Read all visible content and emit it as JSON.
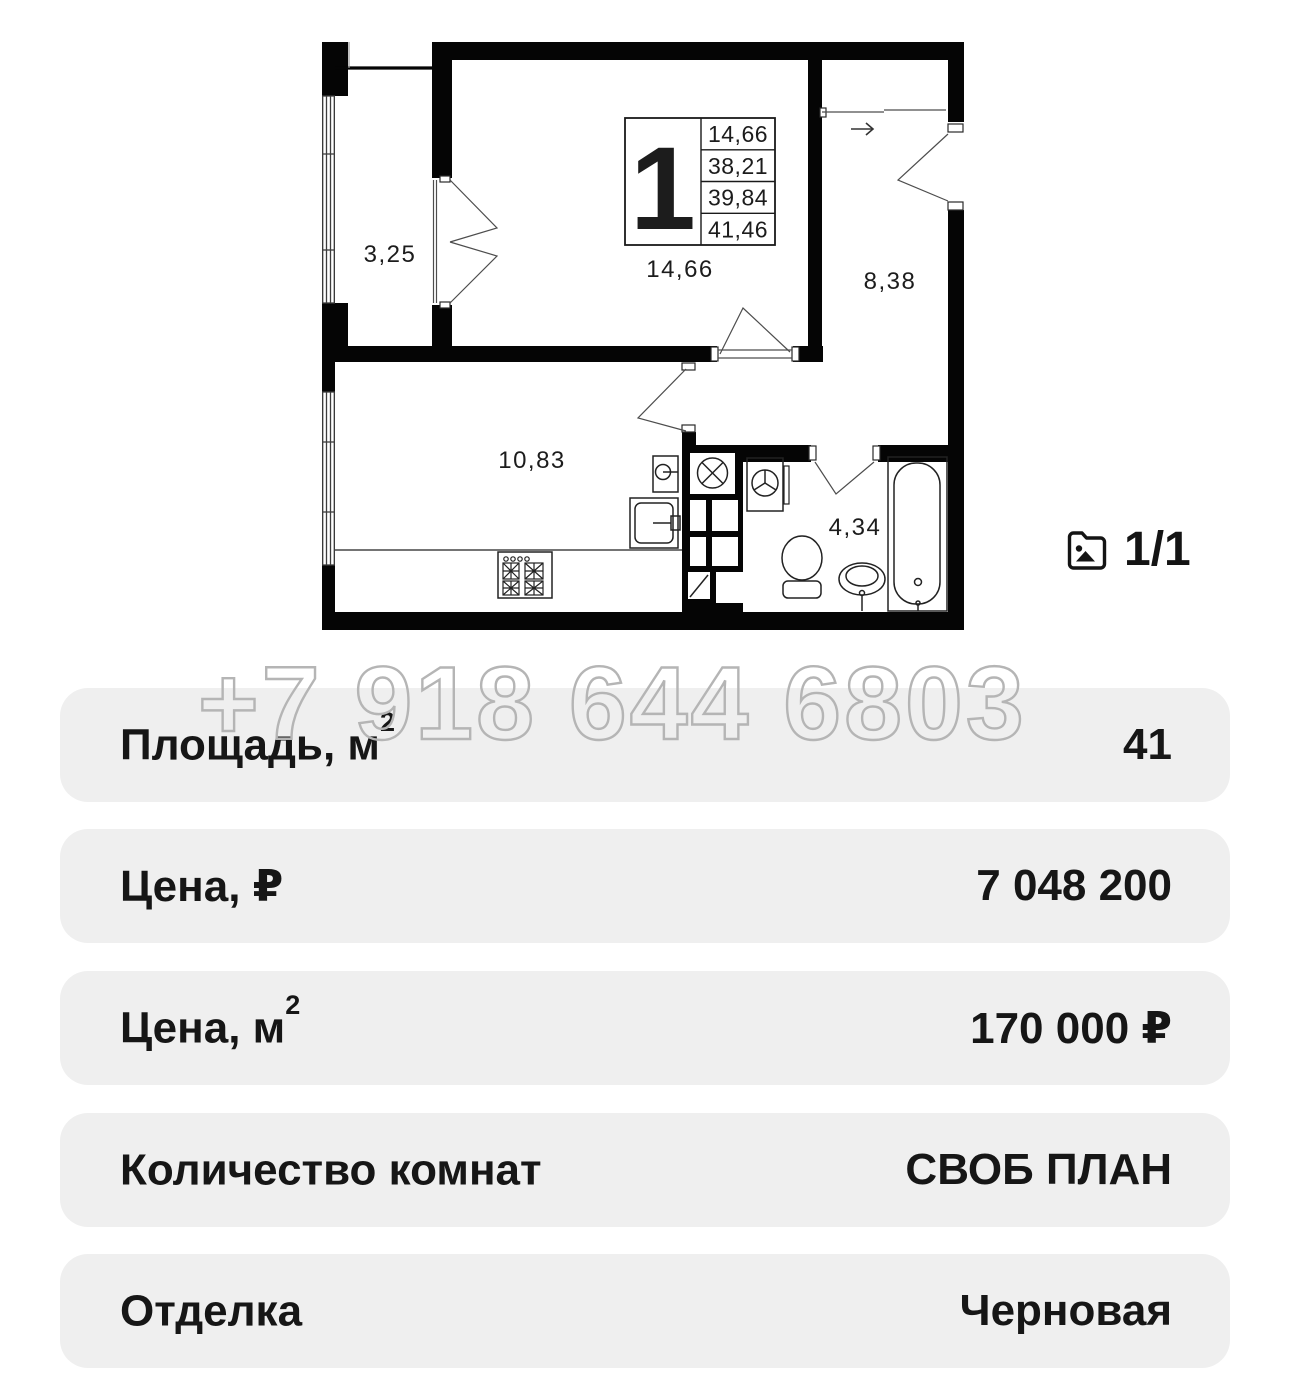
{
  "plan": {
    "unit_info": {
      "number": "1",
      "areas": [
        "14,66",
        "38,21",
        "39,84",
        "41,46"
      ]
    },
    "labels": {
      "living_room": "14,66",
      "loggia": "3,25",
      "hallway": "8,38",
      "kitchen": "10,83",
      "bathroom": "4,34"
    },
    "icons": [
      "entrance-arrow",
      "vent-shaft-icon",
      "stove-icon",
      "sink-icon",
      "washer-icon",
      "toilet-icon",
      "bathtub-icon"
    ]
  },
  "gallery": {
    "icon": "photo-gallery-icon",
    "counter": "1/1"
  },
  "watermark": {
    "phone": "+7 918 644 6803"
  },
  "details": {
    "rows": [
      {
        "label": "Площадь, м",
        "label_sup": "2",
        "value": "41"
      },
      {
        "label": "Цена, ₽",
        "label_sup": "",
        "value": "7 048 200"
      },
      {
        "label": "Цена, м",
        "label_sup": "2",
        "value": "170 000 ₽"
      },
      {
        "label": "Количество комнат",
        "label_sup": "",
        "value": "СВОБ ПЛАН"
      },
      {
        "label": "Отделка",
        "label_sup": "",
        "value": "Черновая"
      }
    ]
  },
  "colors": {
    "walls": "#050505",
    "row_bg": "#efefef",
    "text": "#161616",
    "watermark_outline": "#b5b5b5"
  }
}
